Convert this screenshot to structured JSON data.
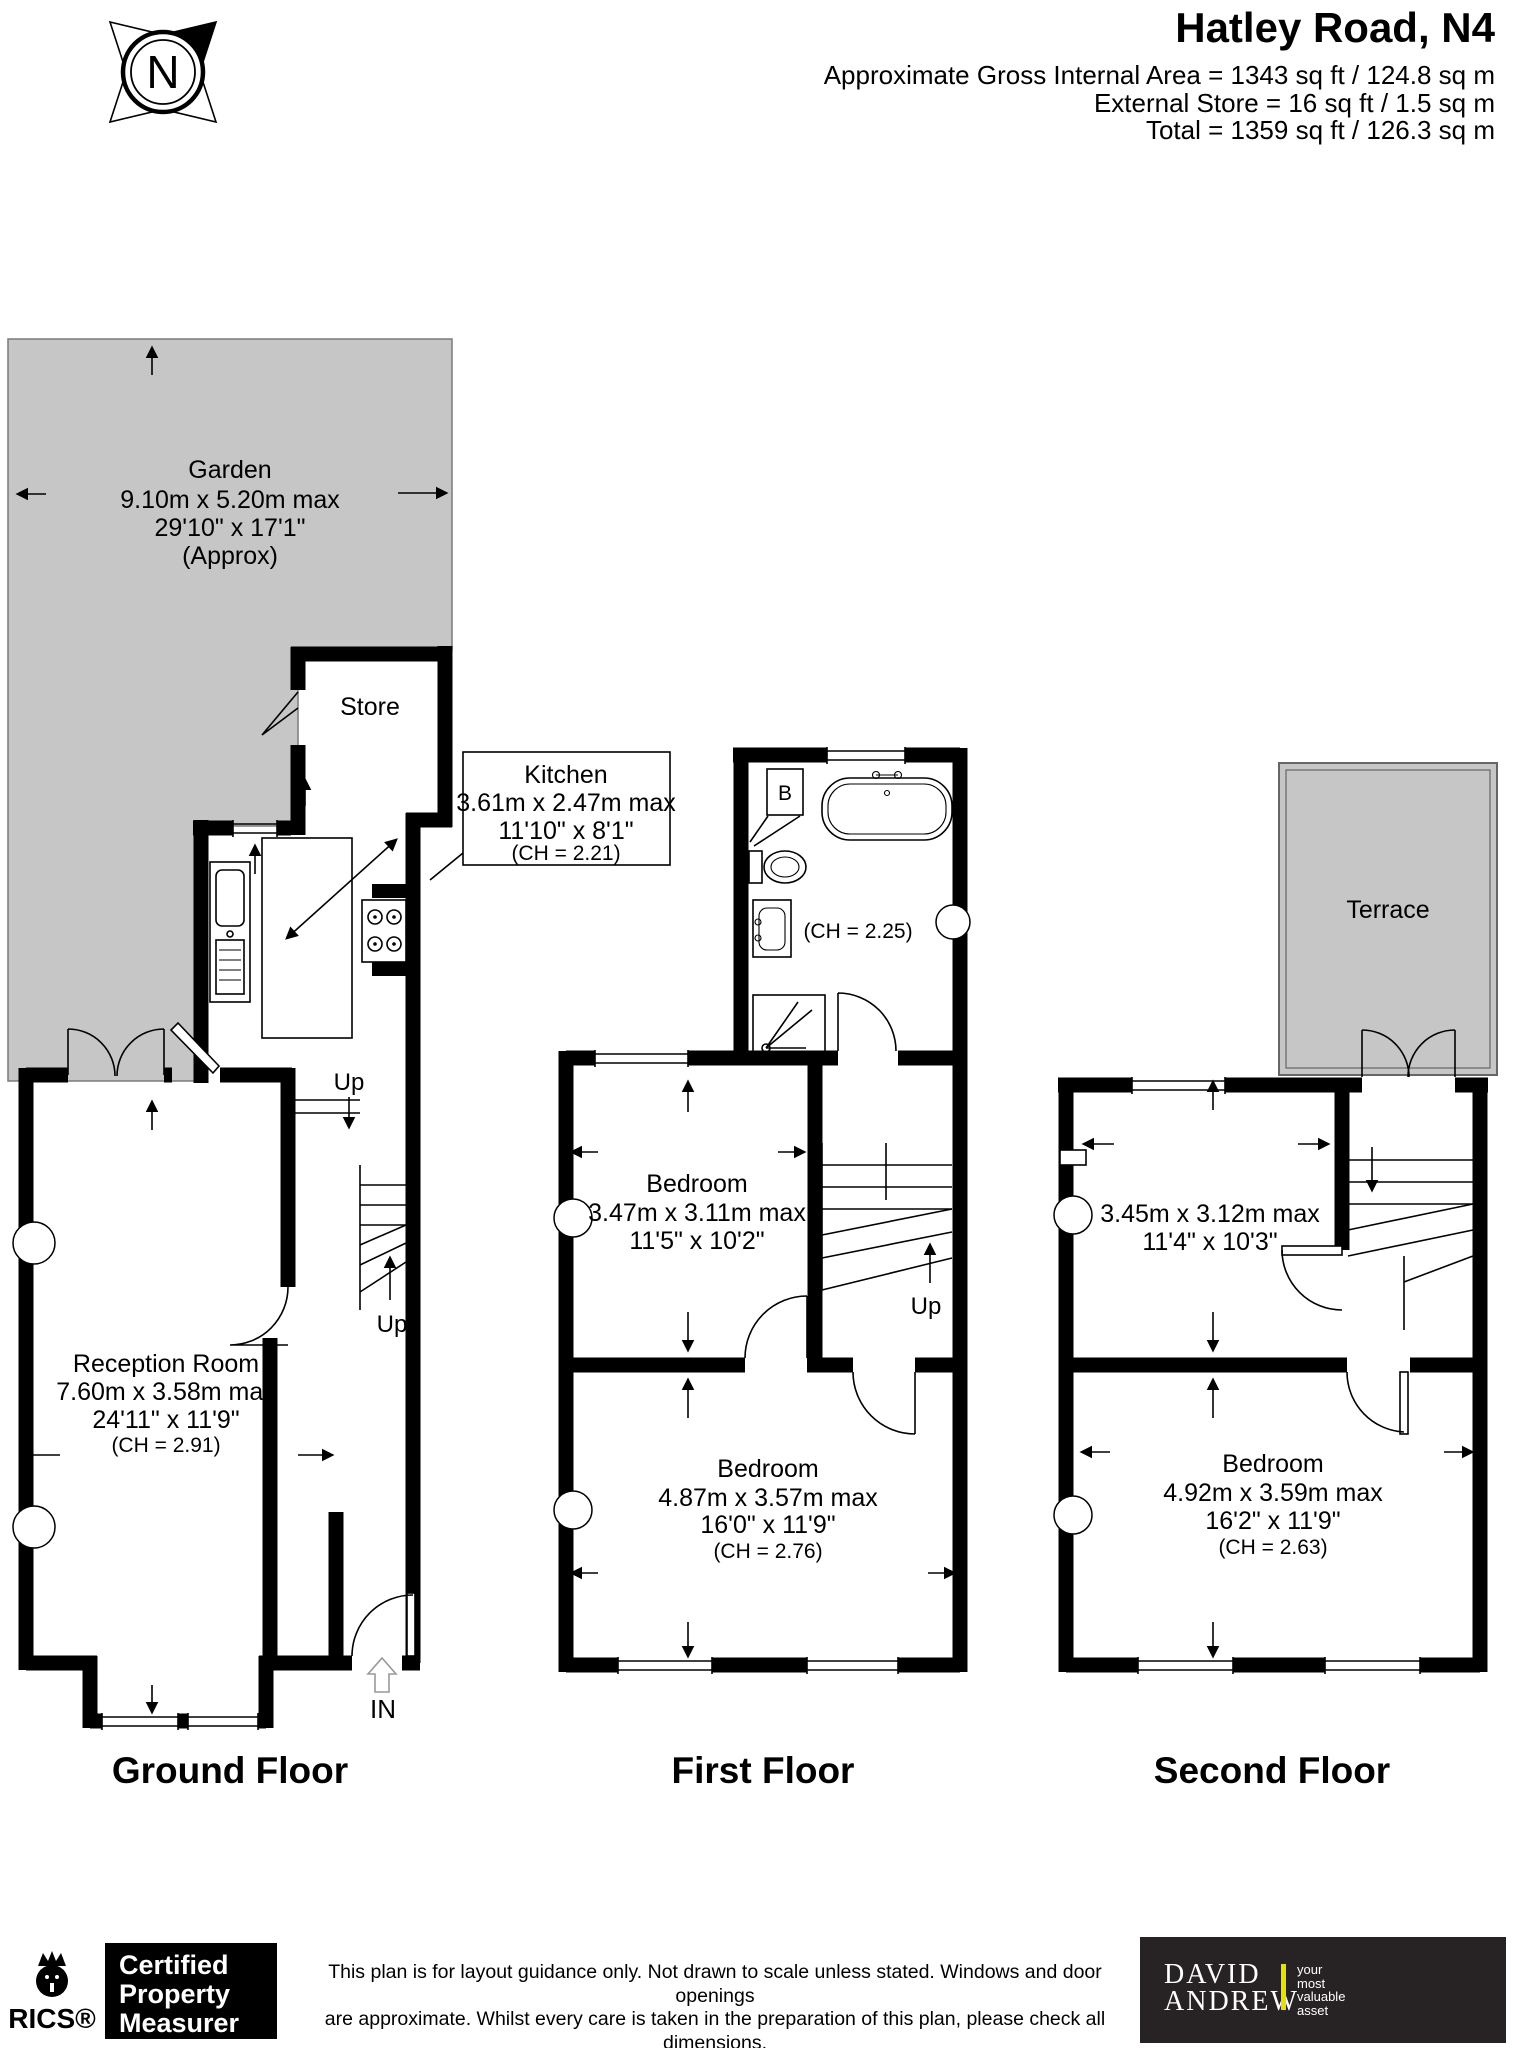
{
  "header": {
    "compass": "N",
    "title": "Hatley Road, N4",
    "area_line": "Approximate Gross Internal Area =  1343 sq ft / 124.8 sq m",
    "store_line": "External Store = 16 sq ft / 1.5 sq m",
    "total_line": "Total = 1359 sq ft / 126.3 sq m"
  },
  "ground_floor": {
    "caption": "Ground Floor",
    "garden": {
      "name": "Garden",
      "dims_m": "9.10m x 5.20m max",
      "dims_ft": "29'10\" x 17'1\"",
      "note": "(Approx)"
    },
    "store_label": "Store",
    "kitchen": {
      "name": "Kitchen",
      "dims_m": "3.61m x 2.47m max",
      "dims_ft": "11'10\" x 8'1\"",
      "ch": "(CH = 2.21)"
    },
    "reception": {
      "name": "Reception Room",
      "dims_m": "7.60m x 3.58m max",
      "dims_ft": "24'11\" x 11'9\"",
      "ch": "(CH = 2.91)"
    },
    "up_steps_label": "Up",
    "up_stairs_label": "Up",
    "entrance_label": "IN"
  },
  "first_floor": {
    "caption": "First Floor",
    "boiler_label": "B",
    "bathroom_ch": "(CH = 2.25)",
    "bedroom_rear": {
      "name": "Bedroom",
      "dims_m": "3.47m x 3.11m max",
      "dims_ft": "11'5\" x 10'2\""
    },
    "bedroom_front": {
      "name": "Bedroom",
      "dims_m": "4.87m x 3.57m max",
      "dims_ft": "16'0\" x 11'9\"",
      "ch": "(CH = 2.76)"
    },
    "up_label": "Up"
  },
  "second_floor": {
    "caption": "Second Floor",
    "terrace_label": "Terrace",
    "rear_room": {
      "dims_m": "3.45m x 3.12m max",
      "dims_ft": "11'4\" x 10'3\""
    },
    "bedroom_front": {
      "name": "Bedroom",
      "dims_m": "4.92m x 3.59m max",
      "dims_ft": "16'2\" x 11'9\"",
      "ch": "(CH = 2.63)"
    }
  },
  "footer": {
    "rics_label": "RICS®",
    "certification": [
      "Certified",
      "Property",
      "Measurer"
    ],
    "disclaimer": [
      "This plan is for layout guidance only. Not drawn to scale unless stated. Windows and door openings",
      "are approximate. Whilst every care is taken in the preparation of this plan, please check all dimensions,",
      "shapes and compass bearings before making any decisions reliant upon them. (ID1202167)"
    ],
    "brand": {
      "line1": "DAVID",
      "line2": "ANDREW",
      "tagline": [
        "your",
        "most",
        "valuable",
        "asset"
      ]
    }
  },
  "colors": {
    "garden_fill": "#c6c6c6",
    "terrace_fill": "#c6c6c6",
    "wall": "#000000",
    "brand_bg": "#272223",
    "brand_accent": "#e5e200"
  }
}
